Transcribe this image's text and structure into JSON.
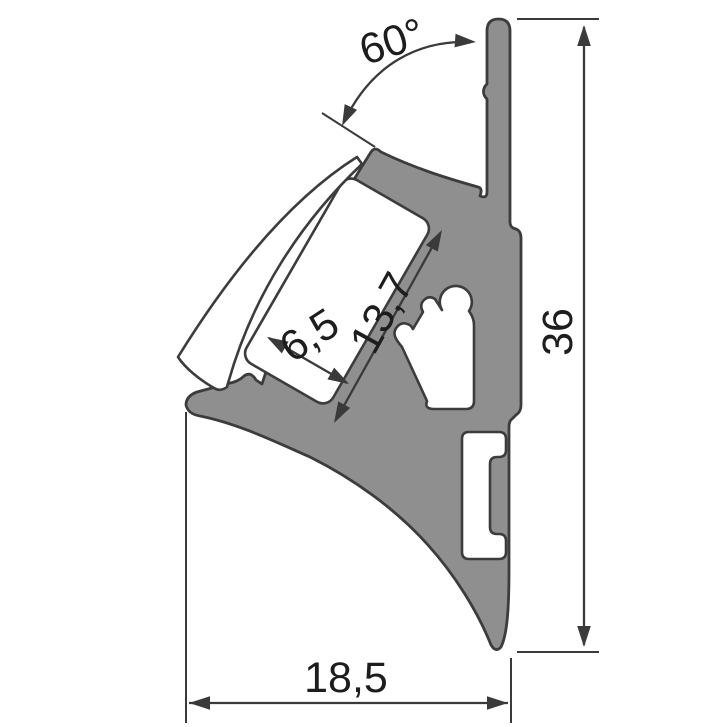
{
  "dimensions": {
    "angle_label": "60°",
    "led_channel_length_label": "13,7",
    "led_channel_width_label": "6,5",
    "profile_height_label": "36",
    "profile_depth_label": "18,5"
  },
  "colors": {
    "aluminum_fill": "#8f8f8f",
    "diffuser_fill": "#ffffff",
    "cavity_fill": "#ffffff",
    "outline": "#3c3c3c",
    "dimension_lines": "#3a3a3a",
    "background": "#ffffff"
  }
}
